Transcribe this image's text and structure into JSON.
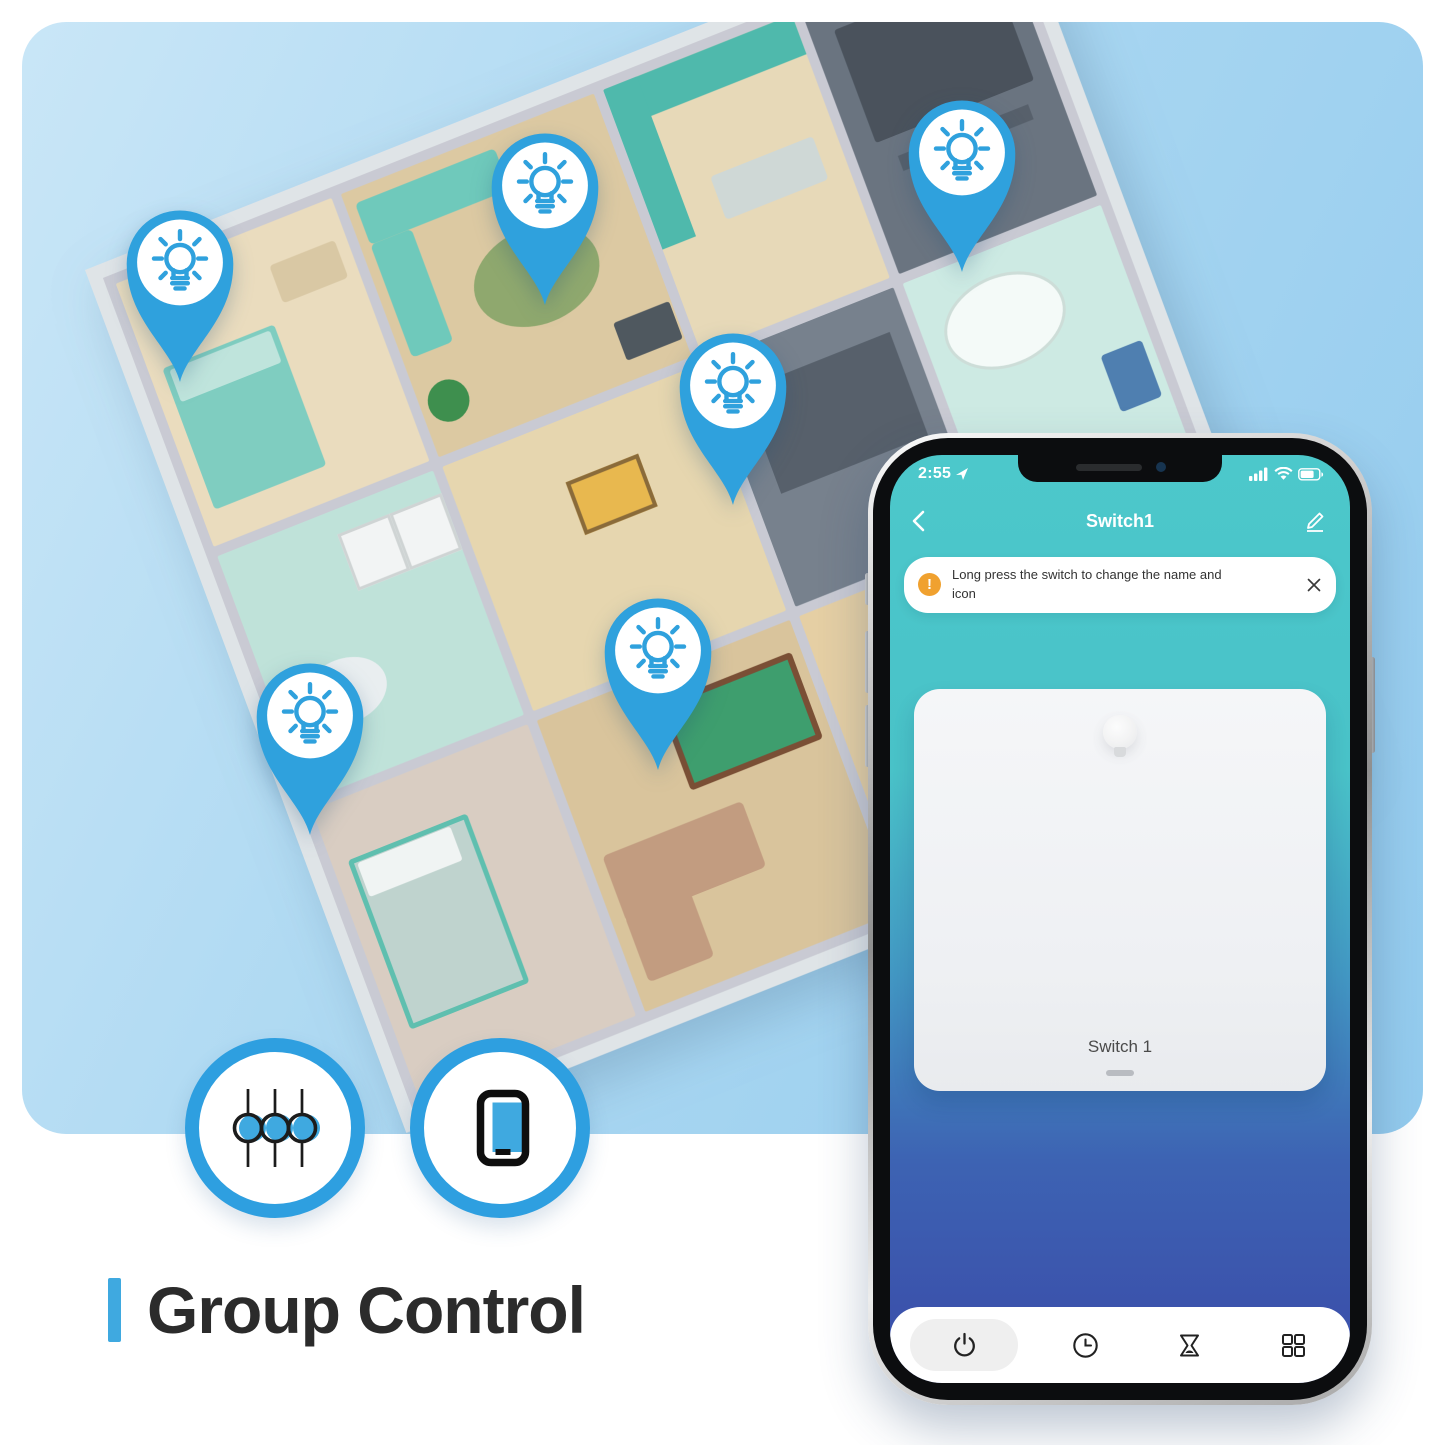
{
  "scene": {
    "caption": "Group Control",
    "colors": {
      "accent_blue": "#3fa9e0",
      "pin_blue": "#2fa1dd",
      "panel_blue": "#abd7f1",
      "teal": "#4ac7ca",
      "deep_blue": "#3b54ae",
      "warning_orange": "#f0a12f"
    },
    "badges": [
      {
        "icon": "sliders-icon"
      },
      {
        "icon": "tablet-icon"
      }
    ],
    "pins": [
      {
        "icon": "light-bulb-pin",
        "x": 158,
        "y": 240
      },
      {
        "icon": "light-bulb-pin",
        "x": 523,
        "y": 163
      },
      {
        "icon": "light-bulb-pin",
        "x": 940,
        "y": 130
      },
      {
        "icon": "light-bulb-pin",
        "x": 711,
        "y": 363
      },
      {
        "icon": "light-bulb-pin",
        "x": 636,
        "y": 628
      },
      {
        "icon": "light-bulb-pin",
        "x": 288,
        "y": 693
      }
    ]
  },
  "phone": {
    "status_bar": {
      "time": "2:55",
      "icons": [
        "location-arrow-icon",
        "signal-bars-icon",
        "wifi-icon",
        "battery-icon"
      ]
    },
    "header": {
      "title": "Switch1",
      "back_icon": "chevron-left-icon",
      "edit_icon": "pencil-icon"
    },
    "banner": {
      "icon": "alert-icon",
      "text": "Long press the switch to change the name and icon",
      "close_icon": "close-icon"
    },
    "switch_card": {
      "label": "Switch 1"
    },
    "toolbar": {
      "items": [
        {
          "icon": "power-icon",
          "active": true
        },
        {
          "icon": "clock-icon",
          "active": false
        },
        {
          "icon": "hourglass-icon",
          "active": false
        },
        {
          "icon": "grid-icon",
          "active": false
        }
      ]
    }
  }
}
